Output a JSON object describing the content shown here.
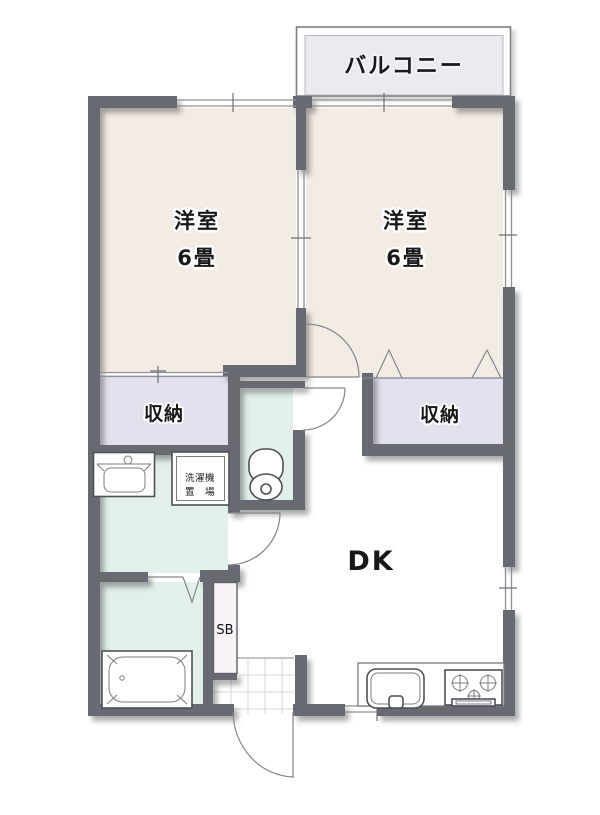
{
  "plan": {
    "type": "apartment-floor-plan",
    "labels": {
      "balcony": "バルコニー",
      "bedroom1_name": "洋室",
      "bedroom1_size": "6畳",
      "bedroom2_name": "洋室",
      "bedroom2_size": "6畳",
      "closet_left": "収納",
      "closet_right": "収納",
      "washer_line1": "洗濯機",
      "washer_line2": "置　場",
      "shoebox": "SB",
      "dining_kitchen": "DK"
    },
    "colors": {
      "wall": "#676b71",
      "room": "#f3ece5",
      "closet": "#e2e1ee",
      "wet": "#e2efeb",
      "balcony": "#e9ebee",
      "white": "#ffffff"
    }
  }
}
